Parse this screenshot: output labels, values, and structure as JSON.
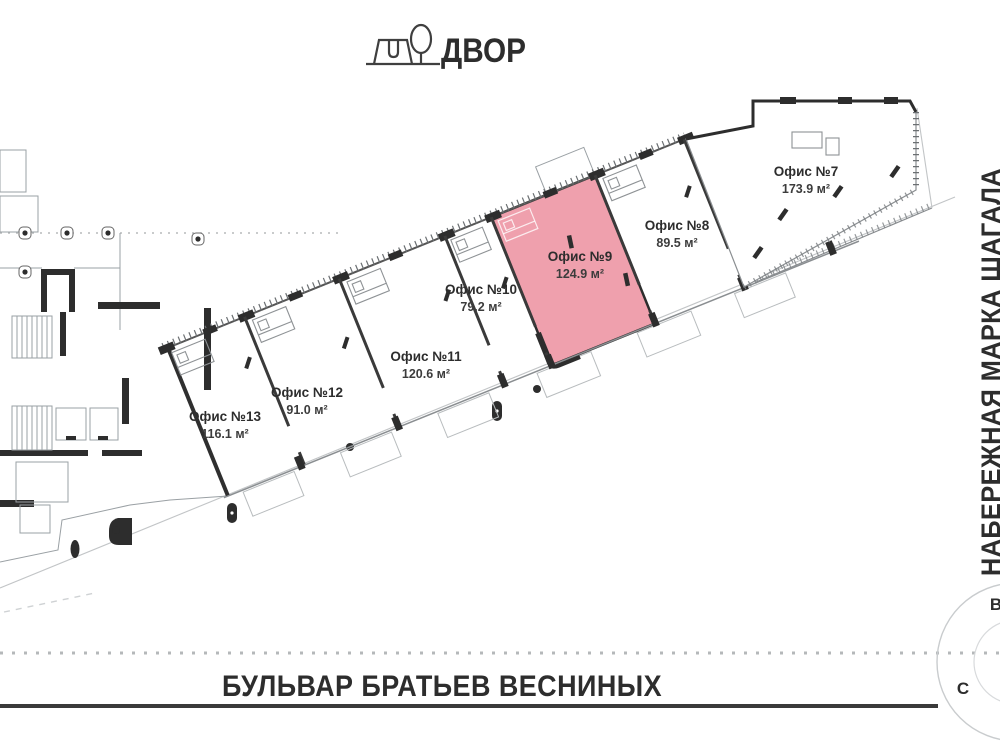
{
  "header": {
    "yard_label": "ДВОР"
  },
  "plan": {
    "highlight_color": "#EFA0AD",
    "offices": [
      {
        "name": "Офис №7",
        "area": "173.9 м²",
        "highlighted": false
      },
      {
        "name": "Офис №8",
        "area": "89.5 м²",
        "highlighted": false
      },
      {
        "name": "Офис №9",
        "area": "124.9 м²",
        "highlighted": true
      },
      {
        "name": "Офис №10",
        "area": "79.2 м²",
        "highlighted": false
      },
      {
        "name": "Офис №11",
        "area": "120.6 м²",
        "highlighted": false
      },
      {
        "name": "Офис №12",
        "area": "91.0 м²",
        "highlighted": false
      },
      {
        "name": "Офис №13",
        "area": "116.1 м²",
        "highlighted": false
      }
    ]
  },
  "streets": {
    "right_vertical": "НАБЕРЕЖНАЯ МАРКА ШАГАЛА",
    "bottom": "БУЛЬВАР БРАТЬЕВ ВЕСНИНЫХ"
  },
  "compass": {
    "north": "С",
    "east": "В"
  }
}
